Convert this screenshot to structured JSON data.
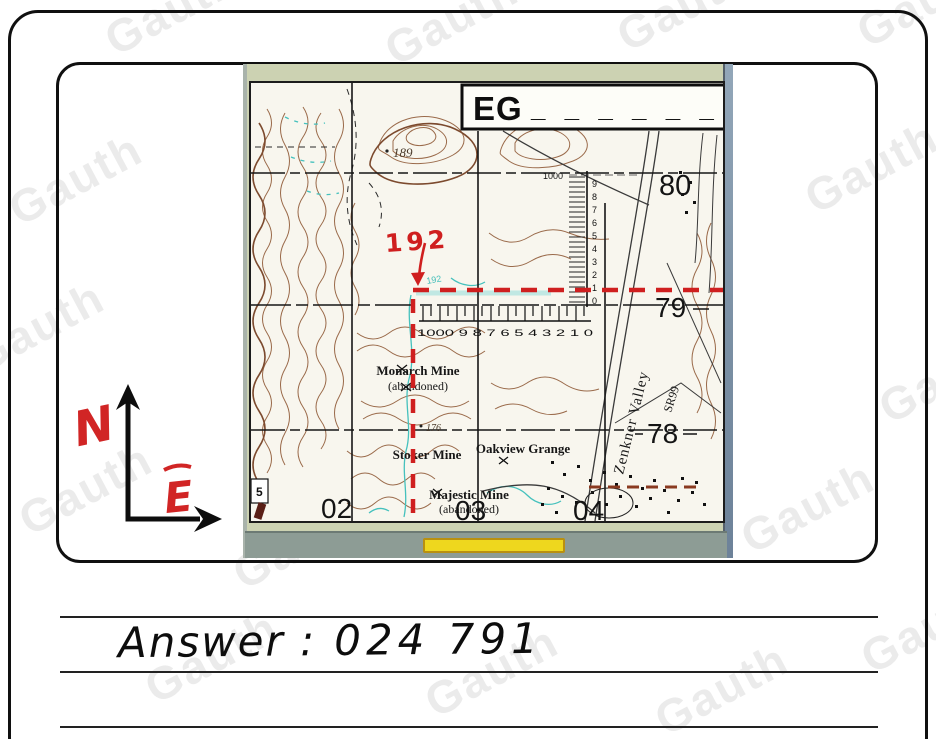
{
  "watermark": {
    "text": "Gauth"
  },
  "compass": {
    "north": "N",
    "east": "E"
  },
  "photo": {
    "title": {
      "prefix": "EG",
      "blanks": "_ _ _ _ _ _"
    },
    "grid": {
      "northings": [
        "80",
        "79",
        "78"
      ],
      "eastings": [
        "02",
        "03",
        "04"
      ],
      "corner_sheet_number": "5"
    },
    "scale": {
      "vertical_top": "1000",
      "vertical_digits": [
        "9",
        "8",
        "7",
        "6",
        "5",
        "4",
        "3",
        "2",
        "1",
        "0"
      ],
      "horizontal": "1000 9 8 7 6 5 4 3 2 1 0"
    },
    "spots": {
      "hill": "189",
      "valley_floor": "176",
      "contour": "192"
    },
    "places": {
      "monarch": "Monarch Mine",
      "monarch_note": "(abandoned)",
      "stoker": "Stoker Mine",
      "oakview": "Oakview Grange",
      "majestic": "Majestic Mine",
      "majestic_note": "(abandoned)",
      "valley": "Zenkner Valley",
      "road": "SR99"
    },
    "annotation": {
      "red_value": "192"
    }
  },
  "answer": {
    "prefix": "Answer :",
    "value": "024 791"
  },
  "colors": {
    "annotation_red": "#cf1f1f",
    "highlight_yellow": "#eed71e",
    "stream_cyan": "#45c1bd",
    "contour_brown": "#9a6a4a",
    "index_contour": "#7c4a2e",
    "photo_frame_green": "#ccd2b2",
    "photo_bar_gray": "#8d9c95"
  }
}
